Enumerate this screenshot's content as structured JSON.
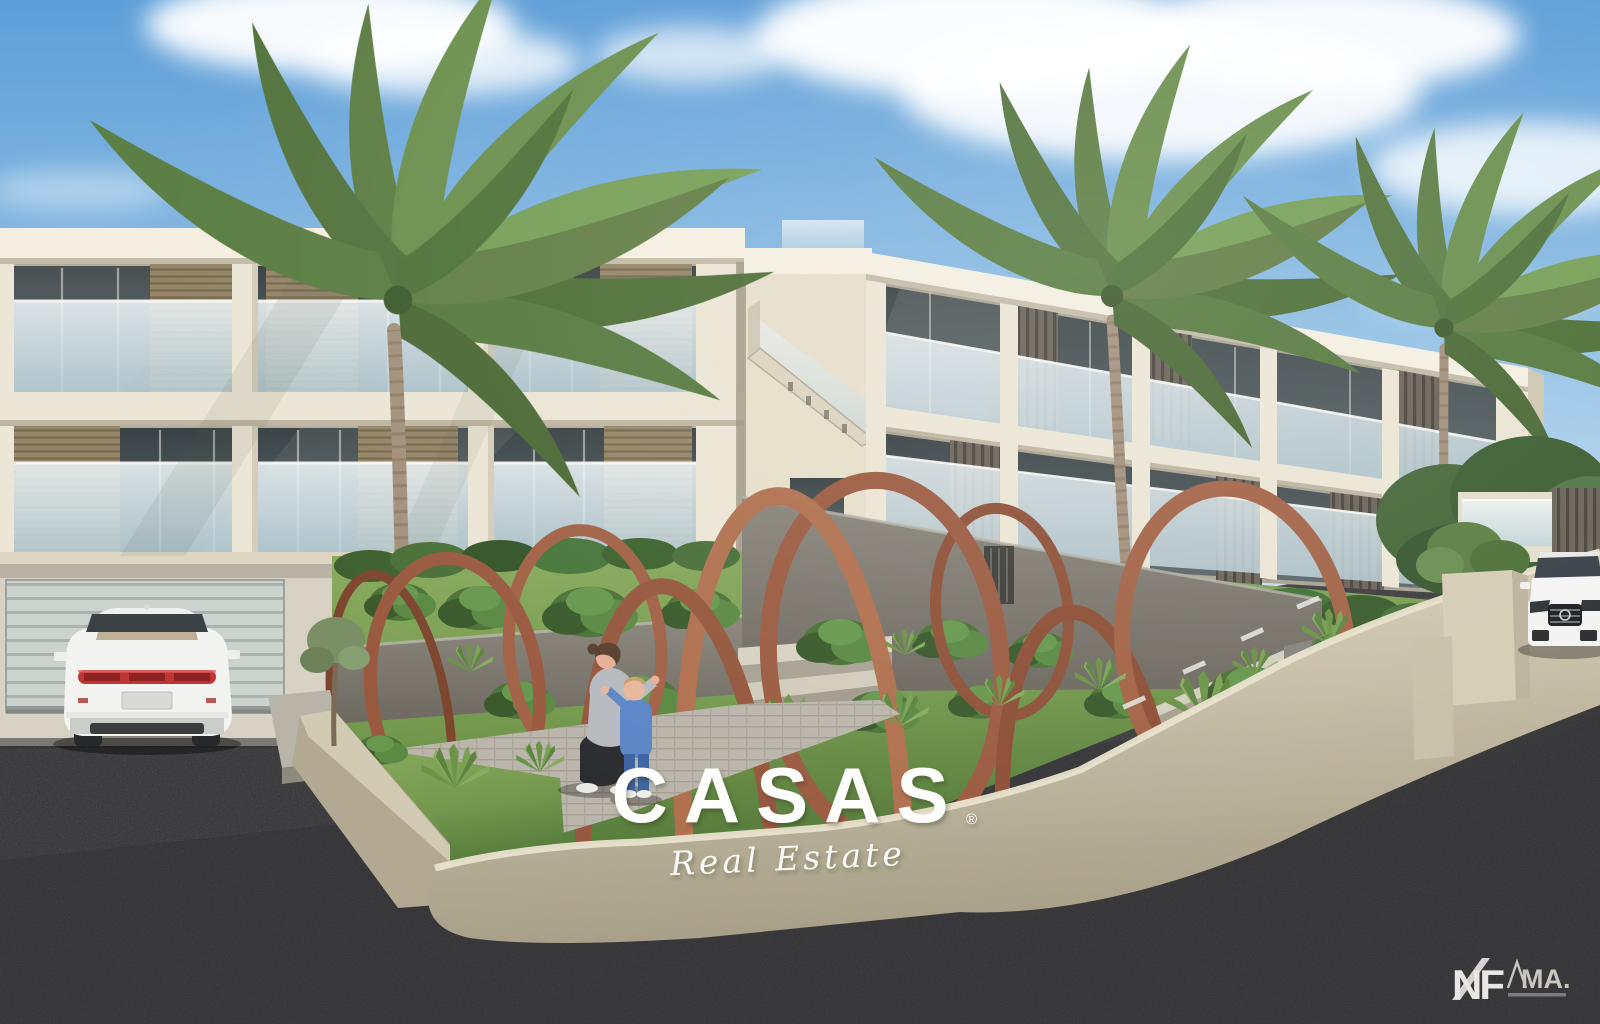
{
  "watermark": {
    "brand": "CASAS",
    "registered": "®",
    "tagline": "Real Estate"
  },
  "footer_logos": {
    "primary": "NF",
    "secondary": "MA."
  },
  "palette": {
    "sky_top": "#5d9ed8",
    "sky_mid": "#93c1e5",
    "sky_horizon": "#cfe3f2",
    "cloud": "#ffffff",
    "concrete": "#ece6d6",
    "concrete_shade": "#cfc7b2",
    "slab_bright": "#f4efe1",
    "glass_frost": "#dce9ef",
    "glass_dark": "#46504f",
    "shutter_tan": "#968668",
    "shutter_dark": "#57524a",
    "rust": "#9c5c42",
    "rust_dark": "#7e462f",
    "rust_light": "#b0714f",
    "grass_light": "#8aab5e",
    "grass": "#74994e",
    "grass_dark": "#55793a",
    "foliage": "#4c7338",
    "foliage_dark": "#3a5a2c",
    "wall_gray": "#8b867c",
    "wall_gray_dark": "#6e6a61",
    "wall_beige": "#c8bfa8",
    "wall_beige_light": "#ddd4bd",
    "asphalt": "#3b3b3d",
    "paver": "#c6c1b7",
    "car_white": "#f3f3f1",
    "taillight_red": "#bf3535",
    "jacket_gray": "#b7babe",
    "outfit_blue": "#5c86c6",
    "trunk_brown": "#a3917c",
    "text_white": "#fdfdfc"
  }
}
